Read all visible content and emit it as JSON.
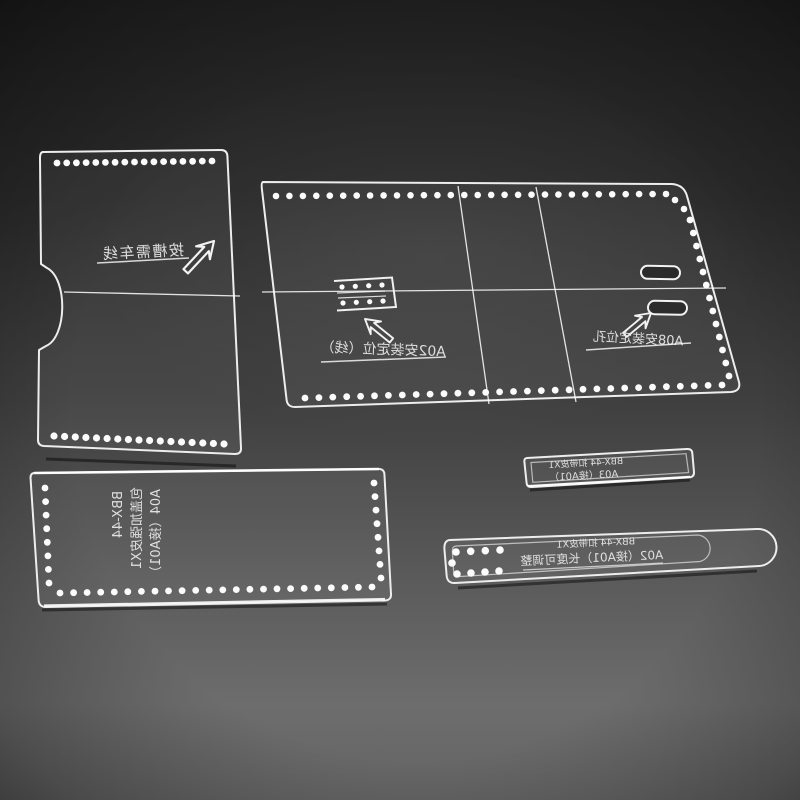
{
  "scene": {
    "subject": "Transparent acrylic leathercraft template set (model BBX-44) photographed on a gray studio background; pieces have laser-cut stitching holes and mirrored engraved Chinese markings",
    "colors": {
      "background_top": "#212121",
      "background_mid": "#3f3f3f",
      "background_bottom": "#6d6d6d",
      "vignette": "rgba(0,0,0,0.5)",
      "acrylic_edge": "#ededed",
      "stitch_hole": "#fbfbfb",
      "engraving": "#e9e9e9"
    }
  },
  "pieces": {
    "body_left": {
      "engraving": "按槽需车线"
    },
    "body_main": {
      "a02_label": "A02安装定位（线）",
      "a08_label": "A08安装定位孔"
    },
    "reinforcement": {
      "line1": "BBX-44",
      "line2": "包盖加强皮X1",
      "line3": "A04（接A01）"
    },
    "strap_small": {
      "line1": "BBX-44 扣带皮X1",
      "line2": "A03（接A01）"
    },
    "strap_long": {
      "line1": "BBX-44 扣带皮X1",
      "line2": "A02（接A01）长度可调整"
    }
  }
}
